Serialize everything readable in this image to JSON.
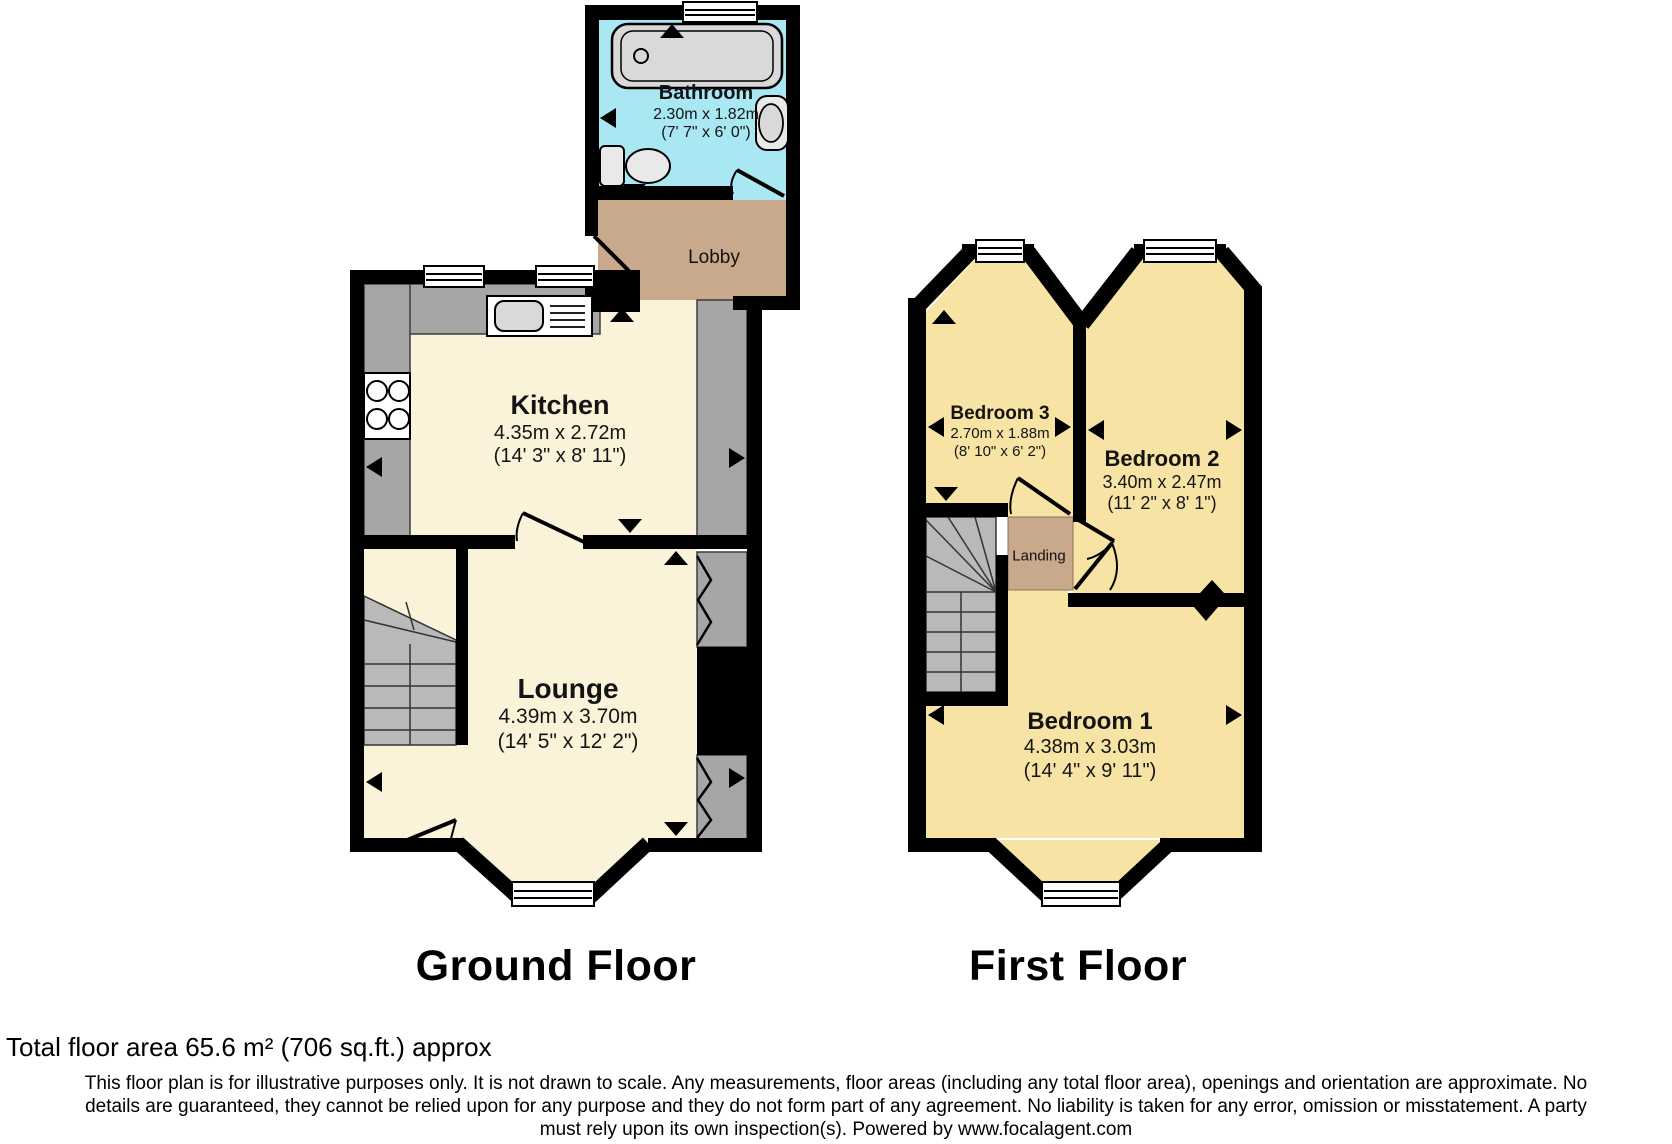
{
  "floors": {
    "ground": {
      "label": "Ground Floor"
    },
    "first": {
      "label": "First Floor"
    }
  },
  "rooms": {
    "bathroom": {
      "name": "Bathroom",
      "metric": "2.30m x 1.82m",
      "imperial": "(7' 7\" x 6' 0\")"
    },
    "lobby": {
      "name": "Lobby"
    },
    "kitchen": {
      "name": "Kitchen",
      "metric": "4.35m x 2.72m",
      "imperial": "(14' 3\" x 8' 11\")"
    },
    "lounge": {
      "name": "Lounge",
      "metric": "4.39m x 3.70m",
      "imperial": "(14' 5\" x 12' 2\")"
    },
    "bedroom3": {
      "name": "Bedroom 3",
      "metric": "2.70m x 1.88m",
      "imperial": "(8' 10\" x 6' 2\")"
    },
    "bedroom2": {
      "name": "Bedroom 2",
      "metric": "3.40m x 2.47m",
      "imperial": "(11' 2\" x 8' 1\")"
    },
    "bedroom1": {
      "name": "Bedroom 1",
      "metric": "4.38m x 3.03m",
      "imperial": "(14' 4\" x 9' 11\")"
    },
    "landing": {
      "name": "Landing"
    }
  },
  "footer": {
    "total_area": "Total floor area 65.6 m² (706 sq.ft.) approx",
    "disclaimer_lines": [
      "This floor plan is for illustrative purposes only. It is not drawn to scale. Any measurements, floor areas (including any total floor area), openings and orientation are approximate. No",
      "details are guaranteed, they cannot be relied upon for any purpose and they do not form part of any agreement. No liability is taken for any error, omission or misstatement. A party",
      "must rely upon its own inspection(s). Powered by www.focalagent.com"
    ]
  },
  "colors": {
    "wall": "#000000",
    "ground_room": "#faf3da",
    "bedroom": "#f7e4a5",
    "bathroom": "#a9e8f3",
    "hall_tan": "#c8a98c",
    "unit_gray": "#a6a6a6",
    "stairs_gray": "#b9b9b9",
    "fixture_gray": "#d9d9d9"
  }
}
